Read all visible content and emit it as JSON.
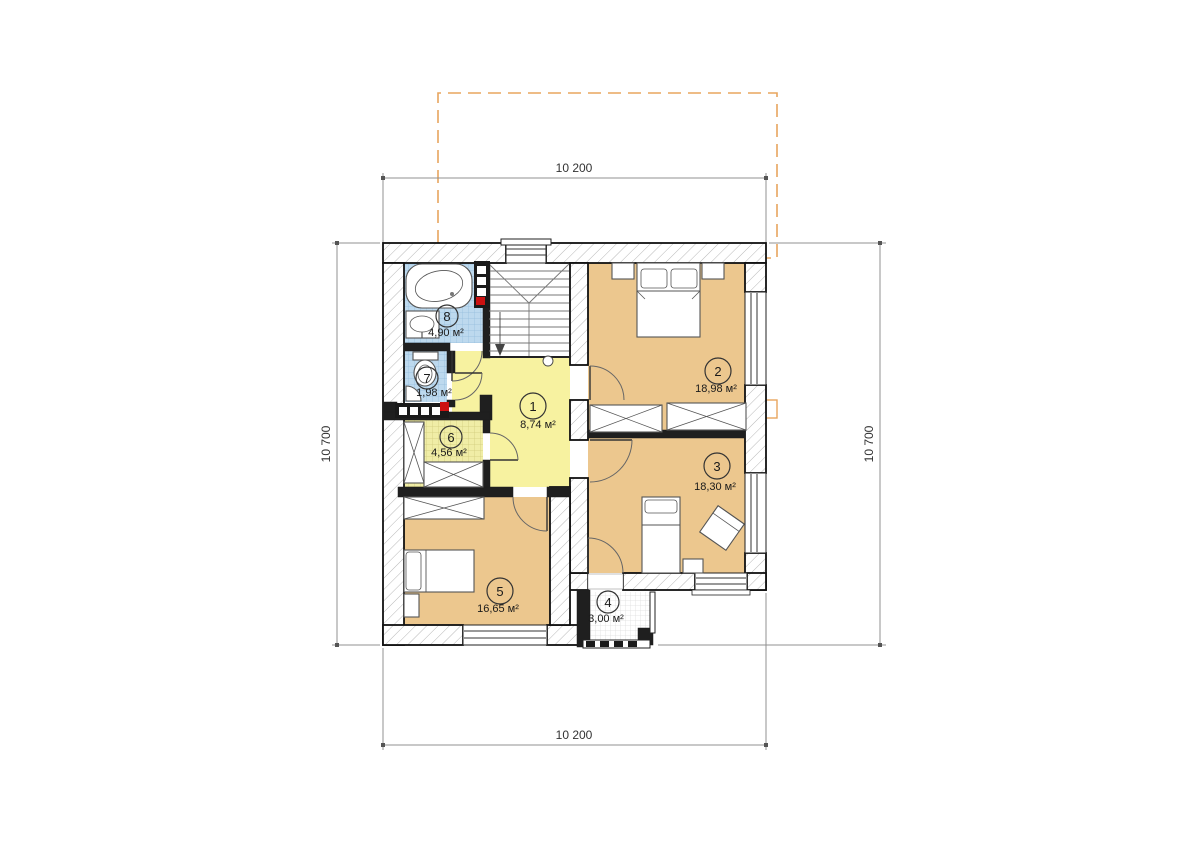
{
  "dimensions": {
    "top": "10 200",
    "bottom": "10 200",
    "left": "10 700",
    "right": "10 700"
  },
  "rooms": [
    {
      "num": "1",
      "area": "8,74 м²"
    },
    {
      "num": "2",
      "area": "18,98 м²"
    },
    {
      "num": "3",
      "area": "18,30 м²"
    },
    {
      "num": "4",
      "area": "3,00 м²"
    },
    {
      "num": "5",
      "area": "16,65 м²"
    },
    {
      "num": "6",
      "area": "4,56 м²"
    },
    {
      "num": "7",
      "area": "1,98 м²"
    },
    {
      "num": "8",
      "area": "4,90 м²"
    }
  ],
  "colors": {
    "bedroom_floor": "#ecc78e",
    "hall_floor": "#f7f2a0",
    "wet_floor": "#bdd9ee",
    "closet_floor": "#f0eda6",
    "balcony_floor": "#ffffff",
    "roof_outline": "#e8a55e",
    "vent_red": "#cc1111"
  }
}
